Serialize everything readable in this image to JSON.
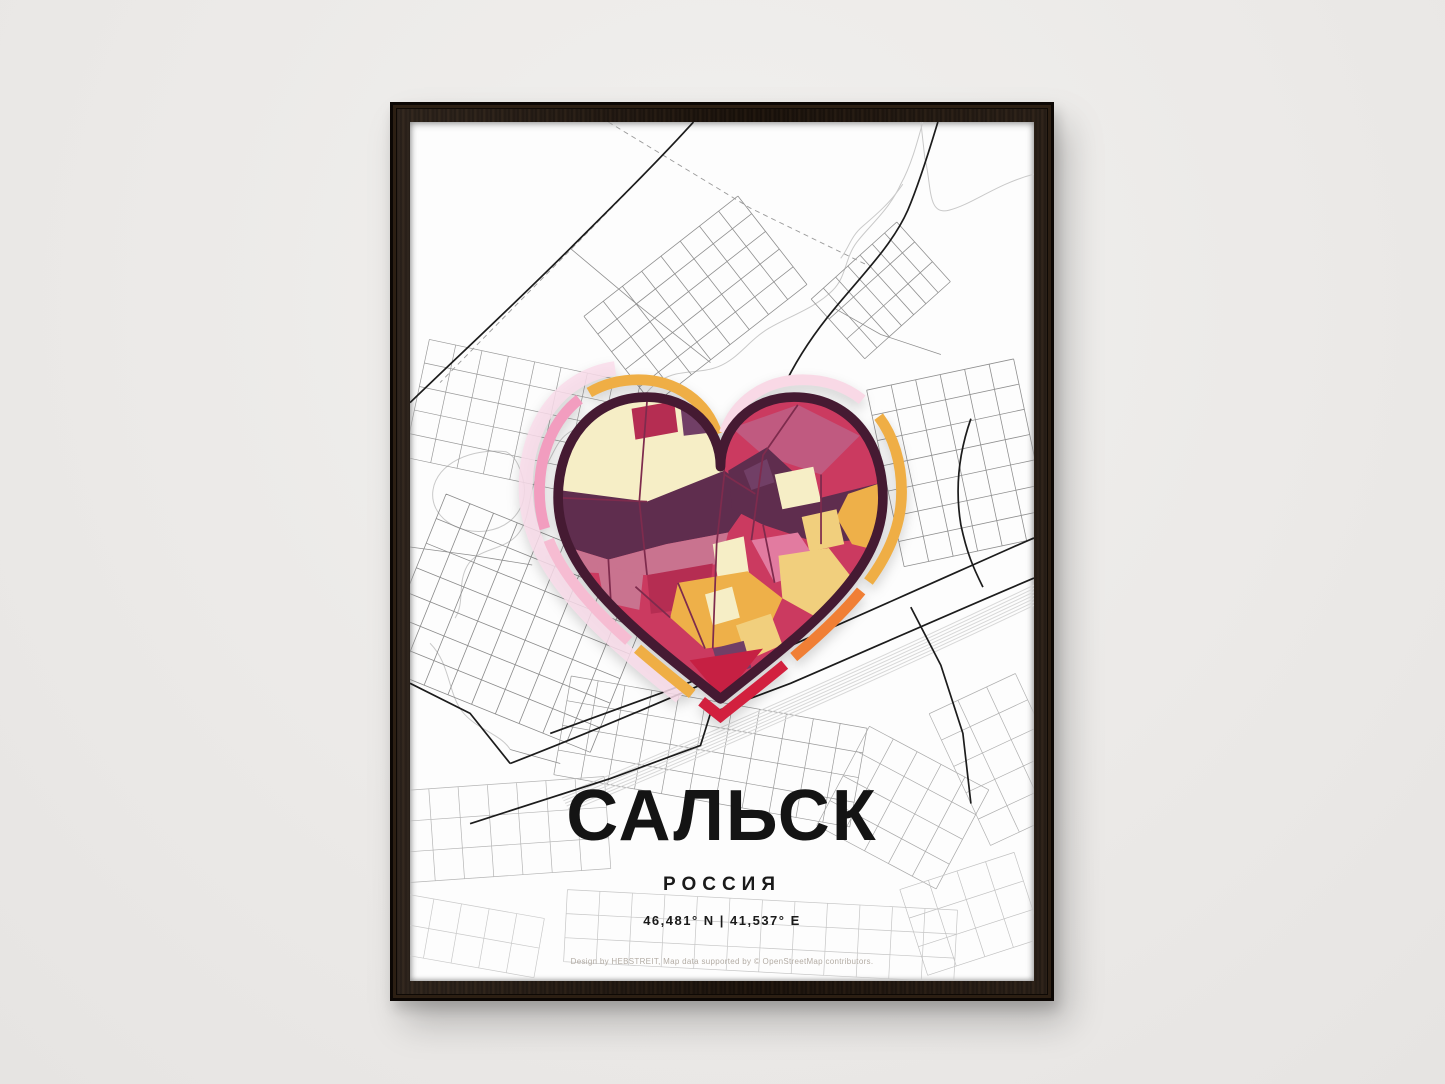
{
  "poster": {
    "title": "САЛЬСК",
    "subtitle": "РОССИЯ",
    "coordinates": "46,481° N | 41,537° E",
    "credit": "Design by HEBSTREIT, Map data supported by © OpenStreetMap contributors."
  },
  "colors": {
    "wall": "#edecea",
    "frame_wood": "#211710",
    "poster_bg": "#fdfdfd",
    "road_major": "#1c1c1c",
    "road_minor": "#8f8f8f",
    "road_faint": "#c2c2c2",
    "water": "#c9c9c9",
    "railway": "#d8d8d8",
    "boundary_dash": "#9a9a9a",
    "heart_outline": "#451a32",
    "heart_base": "#cb3a60",
    "heart_plum": "#5f2d4e",
    "heart_rose": "#c9738f",
    "heart_cream": "#f6eec6",
    "heart_gold": "#eeb049",
    "heart_buff": "#f1cf7d",
    "heart_pink": "#e27ba0",
    "heart_purple": "#713f66",
    "heart_red": "#c62043",
    "heart_street": "#7e2b4d",
    "heart_halo": "#f9dcea"
  },
  "heart_ring_segments": [
    {
      "color": "#efae45",
      "start": 2,
      "len": 13
    },
    {
      "color": "#f29dbf",
      "start": 16,
      "len": 12
    },
    {
      "color": "#f6bcd2",
      "start": 29,
      "len": 11
    },
    {
      "color": "#efae45",
      "start": 41,
      "len": 6
    },
    {
      "color": "#d2203e",
      "start": 48,
      "len": 9
    },
    {
      "color": "#f07f35",
      "start": 58,
      "len": 8
    },
    {
      "color": "#efae45",
      "start": 67,
      "len": 15
    },
    {
      "color": "#f9d9e6",
      "start": 84,
      "len": 14
    }
  ]
}
